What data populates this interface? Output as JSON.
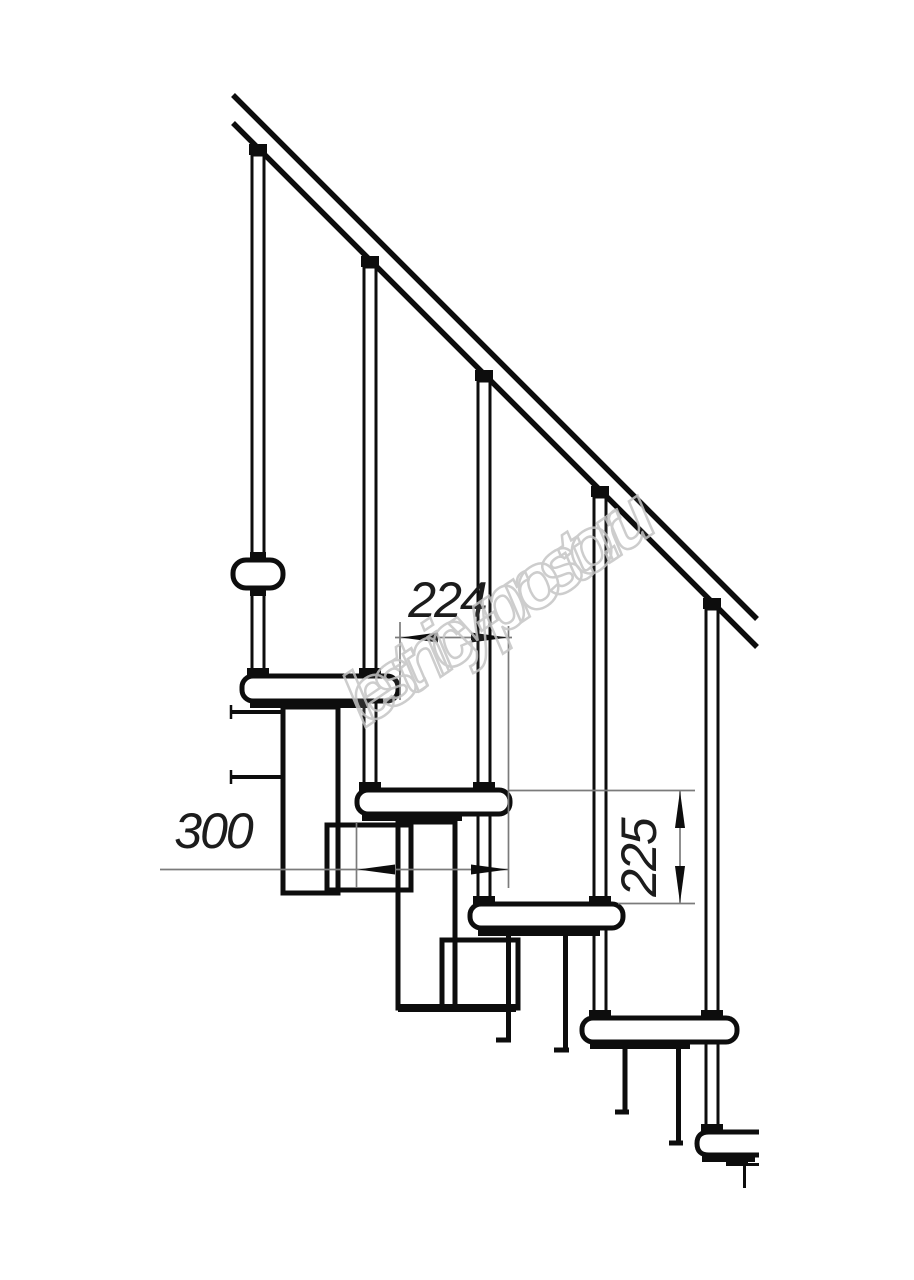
{
  "drawing": {
    "title_hidden": "modular staircase side elevation",
    "colors": {
      "line": "#0d0d0d",
      "dim_line": "#7b7b7b",
      "background": "#ffffff",
      "watermark": "#c5c5c5"
    },
    "dimensions": {
      "step_run": {
        "label": "224"
      },
      "tread_depth": {
        "label": "300"
      },
      "riser_height": {
        "label": "225"
      }
    },
    "watermark": {
      "text": "lestnicy-prosto.ru"
    }
  }
}
